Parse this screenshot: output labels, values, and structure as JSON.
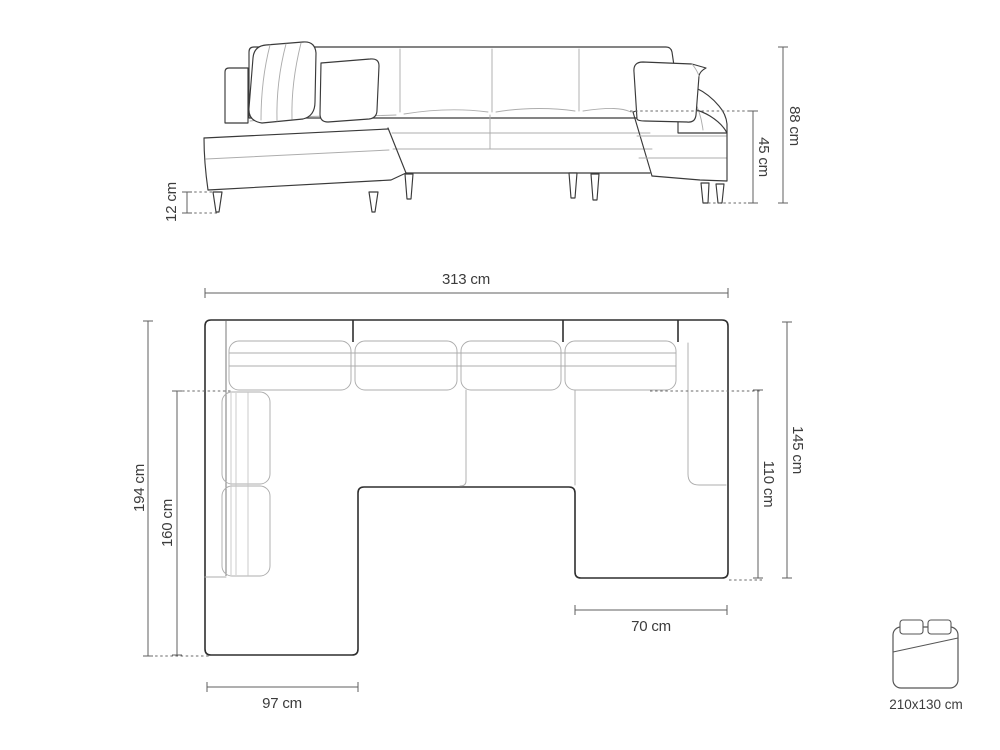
{
  "diagram": {
    "subject": "u-shaped-corner-sofa-dimension-drawing",
    "views": {
      "front_elevation": "front view of sofa",
      "top_plan": "top view of sofa",
      "sleeping_icon": "fold-out bed pictogram"
    }
  },
  "dimensions": {
    "front": {
      "leg_height": "12 cm",
      "seat_height": "45 cm",
      "overall_height": "88 cm"
    },
    "plan": {
      "overall_width": "313 cm",
      "left_side_depth": "194 cm",
      "left_chaise_length": "160 cm",
      "right_side_depth": "145 cm",
      "right_chaise_length": "110 cm",
      "right_chaise_width": "70 cm",
      "left_chaise_width": "97 cm"
    },
    "sleeping_area": "210x130 cm"
  },
  "colors": {
    "background": "#ffffff",
    "outline": "#3a3a3a",
    "light_line": "#adadad",
    "dimension_line": "#5f5f5f",
    "text": "#3c3c3c"
  }
}
